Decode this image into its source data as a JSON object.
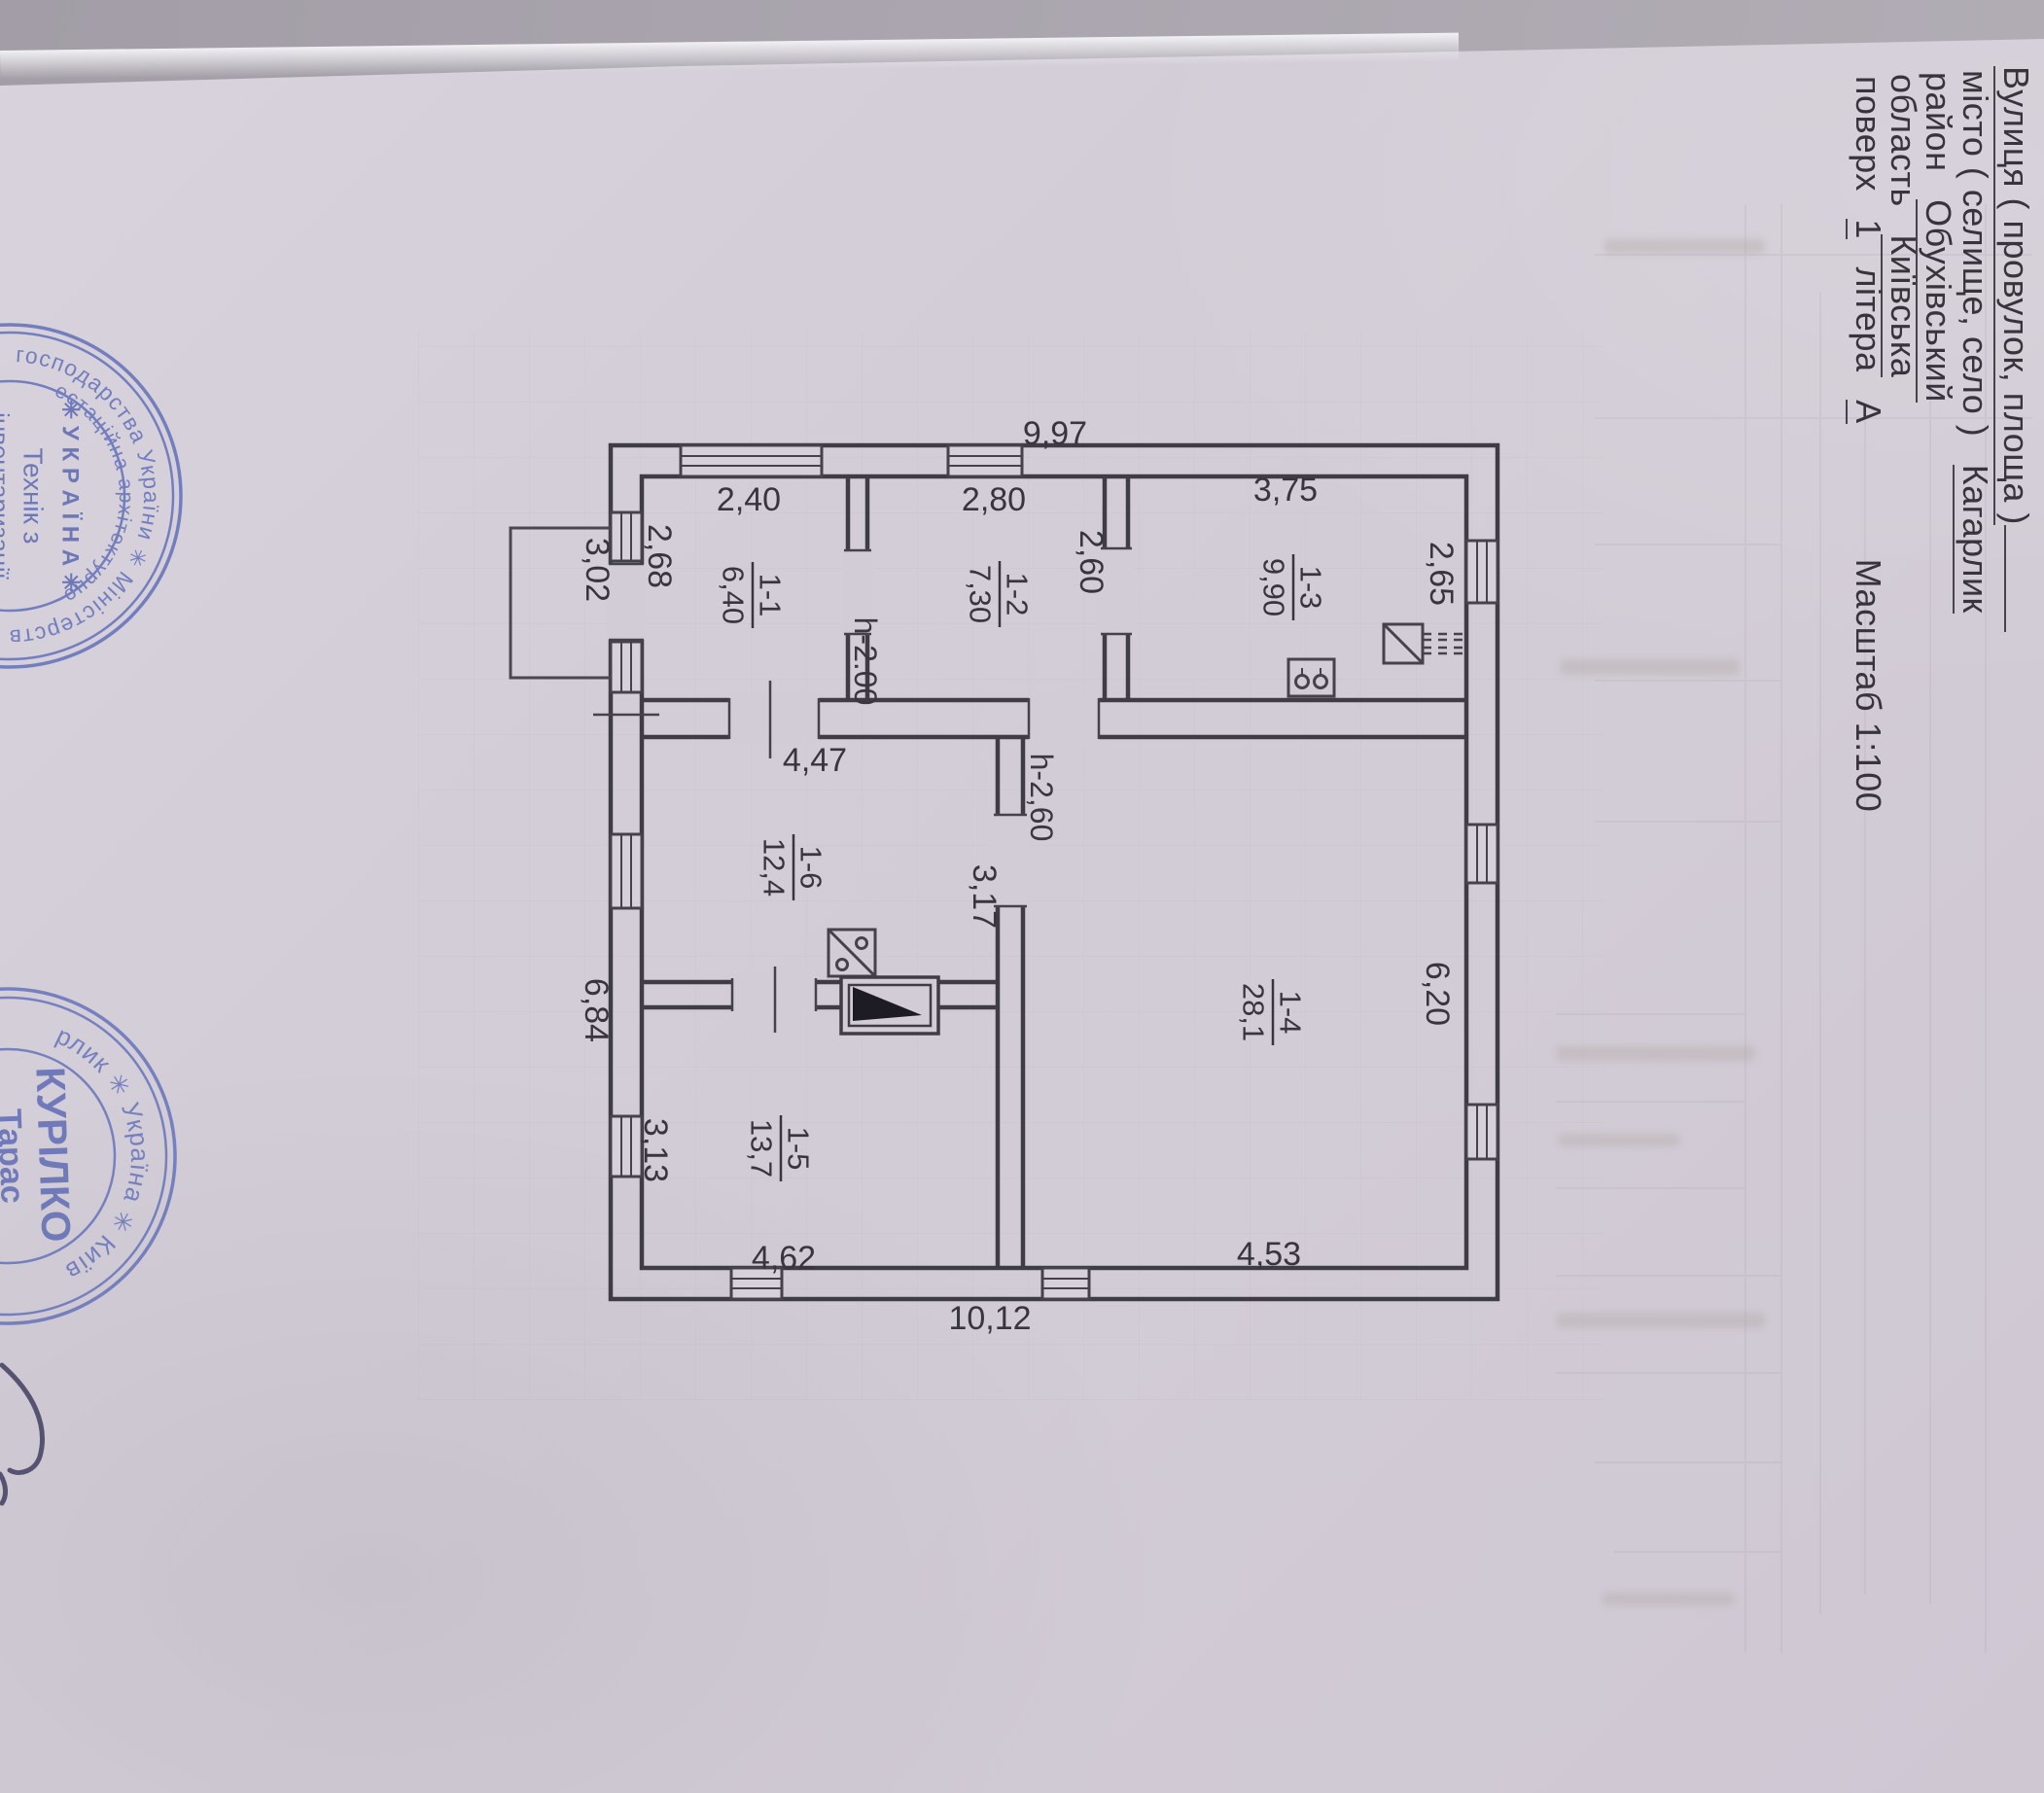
{
  "document": {
    "header": {
      "line1_label": "Вулиця  ( провулок, площа )",
      "line2_label": "місто  ( селище, село )",
      "line2_value": "Кагарлик",
      "line3_label": "район",
      "line3_value": "Обухівський",
      "line4_label": "область",
      "line4_value": "Київська",
      "line5_floor_label": "поверх",
      "line5_floor": "1",
      "line5_letter_label": "літера",
      "line5_letter": "А",
      "scale": "Масштаб 1:100"
    },
    "plan": {
      "rooms": [
        {
          "num": "1-1",
          "area": "6,40"
        },
        {
          "num": "1-2",
          "area": "7,30"
        },
        {
          "num": "1-3",
          "area": "9,90"
        },
        {
          "num": "1-4",
          "area": "28,1"
        },
        {
          "num": "1-5",
          "area": "13,7"
        },
        {
          "num": "1-6",
          "area": "12,4"
        }
      ],
      "dims": {
        "overall_top": "9,97",
        "overall_bottom": "10,12",
        "room11_width": "2,40",
        "room11_depth": "2,68",
        "porch": "3,02",
        "room12_width": "2,80",
        "height_note_1": "h-2.00",
        "hall_depth": "2,60",
        "room13_width": "3,75",
        "room13_side": "2,65",
        "room16_width": "4,47",
        "height_note_2": "h-2,60",
        "passage": "3,17",
        "left_lower": "6,84",
        "room15_side": "3,13",
        "room15_width": "4,62",
        "room14_width": "4,53",
        "room14_side": "6,20"
      }
    },
    "stamps": {
      "tech": {
        "ring_outer_top": "о господарства України  ✳  Міністерство",
        "ring_outer_bottom": "регіонального розвитку",
        "ring_inner_top": "естаційна архітектурно-",
        "ring_inner_bottom": "будівельна комісі",
        "center1": "✳ У К Р А Ї Н А ✳",
        "center2": "Технік з",
        "center3": "інвентаризації",
        "center4": "нерухомого",
        "center5": "майна"
      },
      "fop": {
        "ring_top": "рлик  ✳  Україна  ✳  Київ",
        "ring_bottom": "фізична особа",
        "name": "КУРІЛКО",
        "first_name": "Тарас"
      }
    }
  }
}
